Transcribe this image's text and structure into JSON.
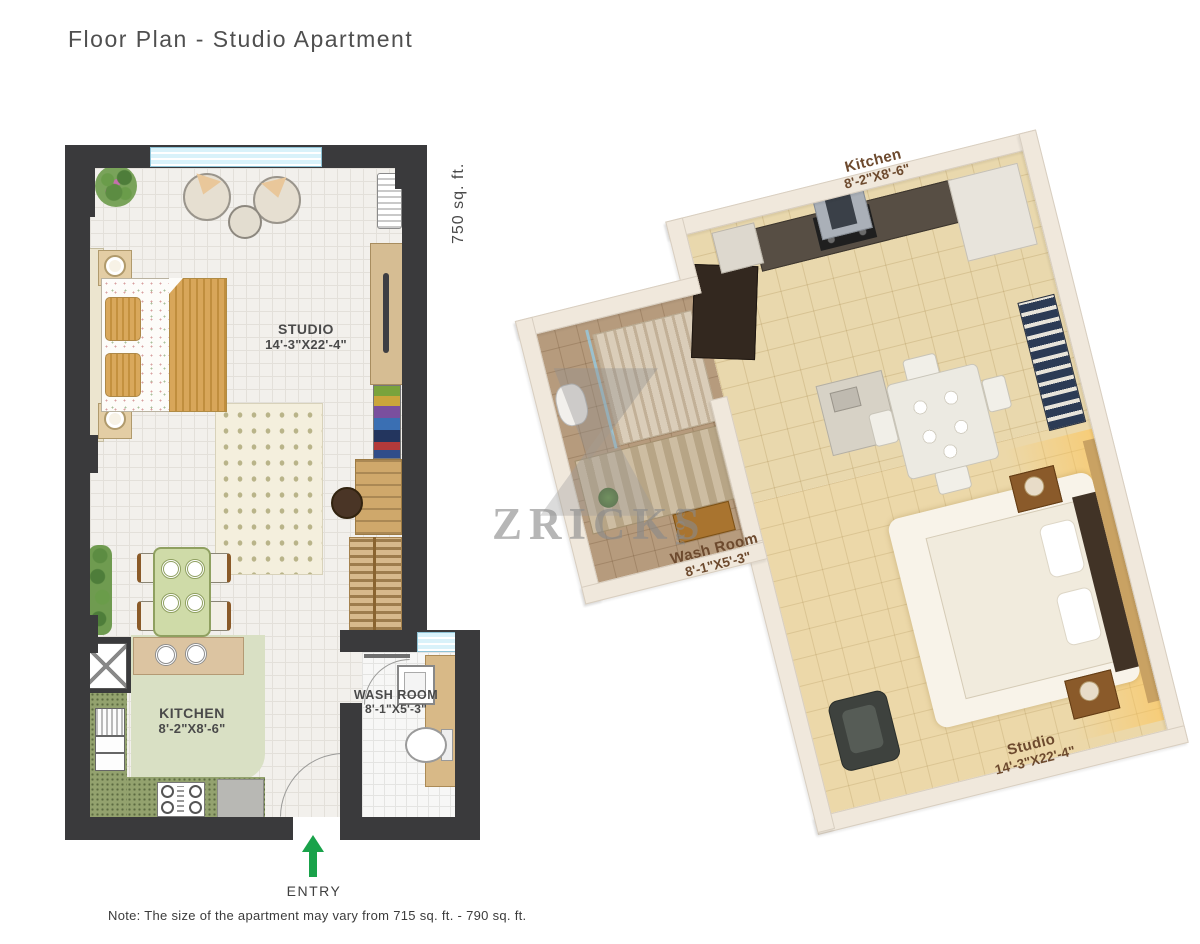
{
  "page": {
    "title": "Floor Plan - Studio Apartment",
    "area_label": "750 sq. ft.",
    "note": "Note: The size of the apartment may vary from 715 sq. ft. - 790 sq. ft."
  },
  "plan2d": {
    "studio": {
      "name": "STUDIO",
      "dims": "14'-3\"X22'-4\""
    },
    "kitchen": {
      "name": "KITCHEN",
      "dims": "8'-2\"X8'-6\""
    },
    "washroom": {
      "name": "WASH ROOM",
      "dims": "8'-1\"X5'-3\""
    },
    "entry_label": "ENTRY"
  },
  "plan3d": {
    "kitchen": {
      "name": "Kitchen",
      "dims": "8'-2\"X8'-6\""
    },
    "washroom": {
      "name": "Wash Room",
      "dims": "8'-1\"X5'-3\""
    },
    "studio": {
      "name": "Studio",
      "dims": "14'-3\"X22'-4\""
    }
  },
  "watermark": {
    "brand": "ZRICKS",
    "tld": "COM"
  },
  "colors": {
    "wall": "#3a3a3c",
    "floor": "#f2f0ec",
    "kitchen_green": "#93a26e",
    "entry_green": "#19a24a",
    "label_brown": "#6d4a2e",
    "watermark_gray": "#8a8a8a",
    "window_blue": "#d9f2fa"
  }
}
